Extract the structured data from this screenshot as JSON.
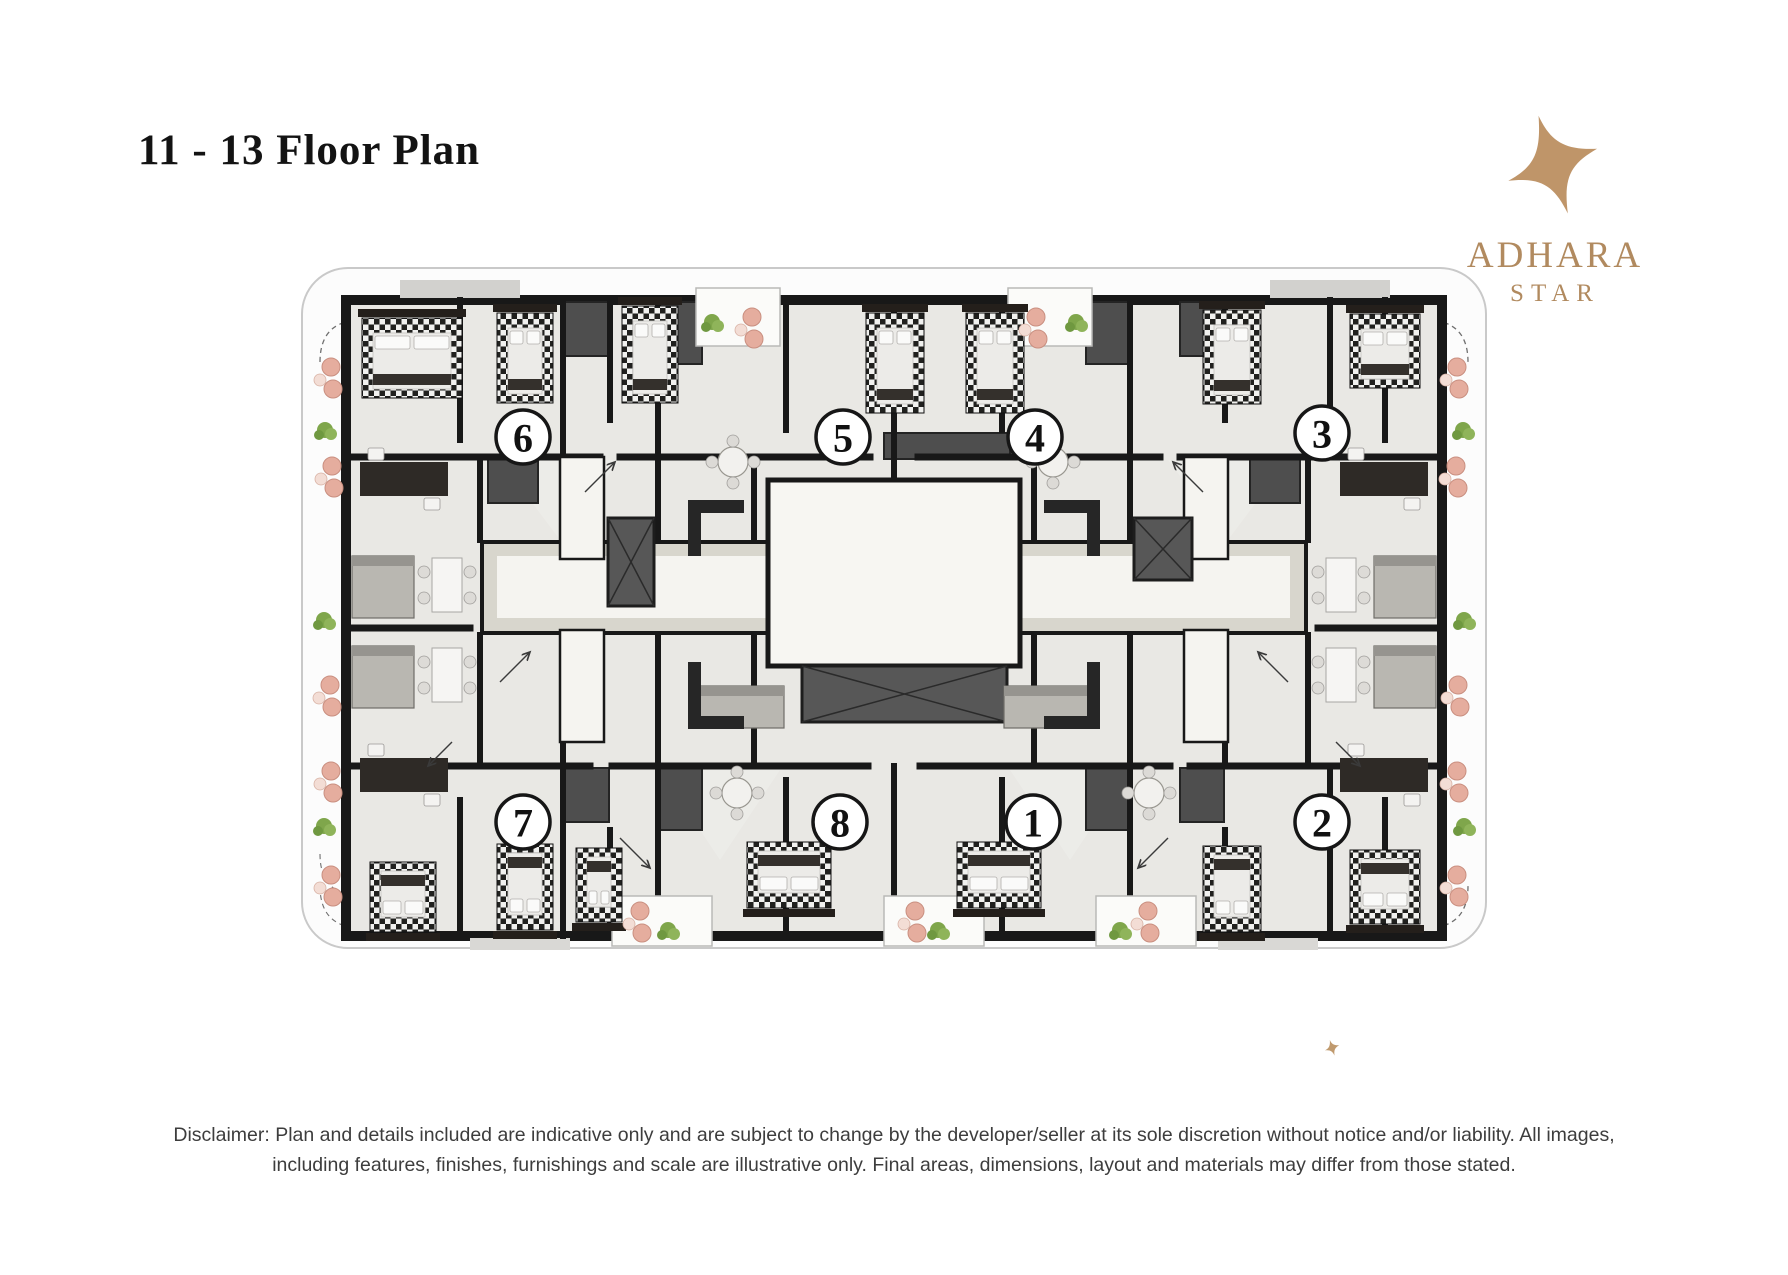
{
  "header": {
    "title": "11 - 13 Floor Plan"
  },
  "logo": {
    "brand": "ADHARA",
    "sub_brand": "STAR",
    "color": "#b18a5f",
    "icon": "four-point-star-icon"
  },
  "floor_plan": {
    "units": [
      {
        "label": "6",
        "x": 523,
        "y": 437
      },
      {
        "label": "5",
        "x": 843,
        "y": 437
      },
      {
        "label": "4",
        "x": 1035,
        "y": 437
      },
      {
        "label": "3",
        "x": 1322,
        "y": 433
      },
      {
        "label": "7",
        "x": 523,
        "y": 822
      },
      {
        "label": "8",
        "x": 840,
        "y": 822
      },
      {
        "label": "1",
        "x": 1033,
        "y": 822
      },
      {
        "label": "2",
        "x": 1322,
        "y": 822
      }
    ],
    "colors": {
      "wall": "#181818",
      "floor": "#e9e8e4",
      "corridor": "#d8d6cd",
      "lobby": "#f7f6f2",
      "balcony": "#fcfcfc",
      "bed_check_dark": "#20201e",
      "chair_pink": "#e5ad9e",
      "plant_green": "#7fa64b",
      "elevator": "#575757",
      "accent_gold": "#c09a6e"
    }
  },
  "footer": {
    "disclaimer_line1": "Disclaimer: Plan and details included are indicative only and are subject to change by the developer/seller at its sole discretion without notice and/or liability. All images,",
    "disclaimer_line2": "including features, finishes, furnishings and scale are illustrative only. Final areas, dimensions, layout and materials may differ from those stated."
  }
}
